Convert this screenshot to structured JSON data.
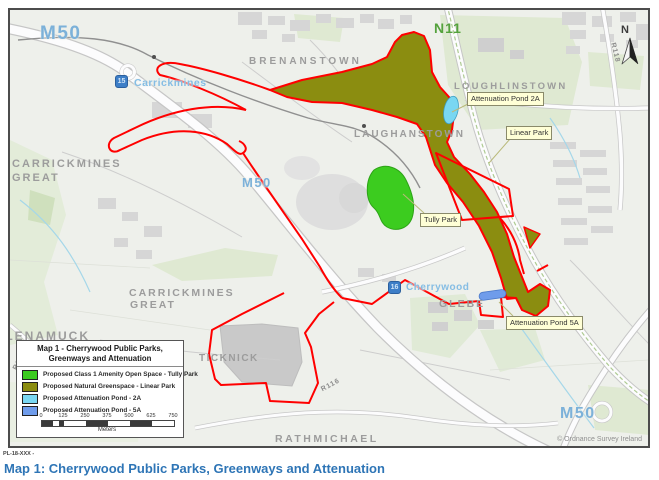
{
  "page": {
    "code": "PL-18-XXX -",
    "caption": "Map 1: Cherrywood Public Parks, Greenways and Attenuation"
  },
  "colors": {
    "boundary_red": "#ff0000",
    "amenity_green": "#3ccc1f",
    "greenspace_olive": "#8b8d10",
    "pond_2a_blue": "#79d7f2",
    "pond_5a_blue": "#6f9ceb",
    "caption_blue": "#2e75b6"
  },
  "map": {
    "labels": {
      "m50_nw": "M50",
      "m50_mid": "M50",
      "m50_se": "M50",
      "n11": "N11",
      "brenanstown": "BRENANSTOWN",
      "loughlinstown": "LOUGHLINSTOWN",
      "laughanstown": "LAUGHANSTOWN",
      "carrickmines_great_line1": "CARRICKMINES",
      "carrickmines_great_line2": "GREAT",
      "glenamuck": "GLENAMUCK",
      "ticknick": "TICKNICK",
      "glebe": "GLEBE",
      "rathmichael": "RATHMICHAEL",
      "r116": "R116",
      "r842": "R842",
      "r118": "R118",
      "north": "N"
    },
    "junctions": [
      {
        "number": "15",
        "name": "Carrickmines"
      },
      {
        "number": "16",
        "name": "Cherrywood"
      }
    ],
    "callouts": {
      "pond_2a": "Attenuation Pond 2A",
      "linear_park": "Linear Park",
      "tully_park": "Tully Park",
      "pond_5a": "Attenuation Pond 5A"
    },
    "copyright": "© Ordnance Survey Ireland"
  },
  "legend": {
    "title_line1": "Map 1 - Cherrywood Public Parks,",
    "title_line2": "Greenways and Attenuation",
    "items": [
      {
        "label": "Proposed Class 1 Amenity Open Space - Tully Park",
        "color": "#3ccc1f"
      },
      {
        "label": "Proposed Natural Greenspace - Linear Park",
        "color": "#8b8d10"
      },
      {
        "label": "Proposed Attenuation Pond - 2A",
        "color": "#79d7f2"
      },
      {
        "label": "Proposed Attenuation Pond - 5A",
        "color": "#6f9ceb"
      }
    ],
    "scale": {
      "ticks": [
        "0",
        "125",
        "250",
        "375",
        "500",
        "625",
        "750"
      ],
      "unit": "Meters"
    }
  }
}
